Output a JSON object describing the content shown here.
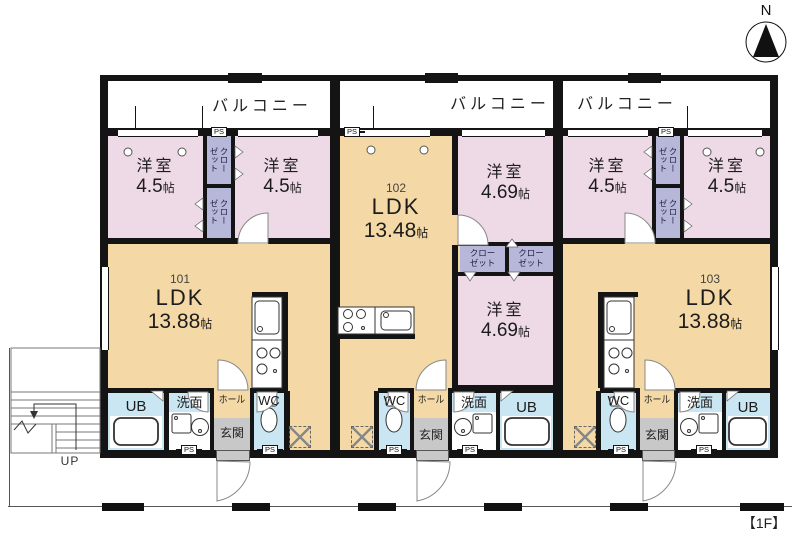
{
  "compass": {
    "label": "N"
  },
  "floor_tag": "【1F】",
  "stairs": {
    "up": "UP"
  },
  "labels": {
    "balcony": "バルコニー",
    "room": "洋室",
    "ldk": "LDK",
    "unit_tatami": "帖",
    "closet": "クローゼット",
    "closet_l1": "クロー",
    "closet_l2": "ゼット",
    "ps": "PS",
    "wc": "WC",
    "ub": "UB",
    "washroom": "洗面",
    "hall": "ホール",
    "entrance": "玄関"
  },
  "units": {
    "u101": {
      "number": "101",
      "ldk_size": "13.88",
      "room1_size": "4.5",
      "room2_size": "4.5"
    },
    "u102": {
      "number": "102",
      "ldk_size": "13.48",
      "room_top_size": "4.69",
      "room_bottom_size": "4.69"
    },
    "u103": {
      "number": "103",
      "ldk_size": "13.88",
      "room1_size": "4.5",
      "room2_size": "4.5"
    }
  },
  "colors": {
    "bedroom_pink": "#eed9e6",
    "ldk_tan": "#f4d9a6",
    "wet_area_blue": "#c9e6f2",
    "closet_purple": "#b7b8d9",
    "entrance_gray": "#c8c8c8",
    "white": "#ffffff",
    "wall_black": "#141414"
  }
}
